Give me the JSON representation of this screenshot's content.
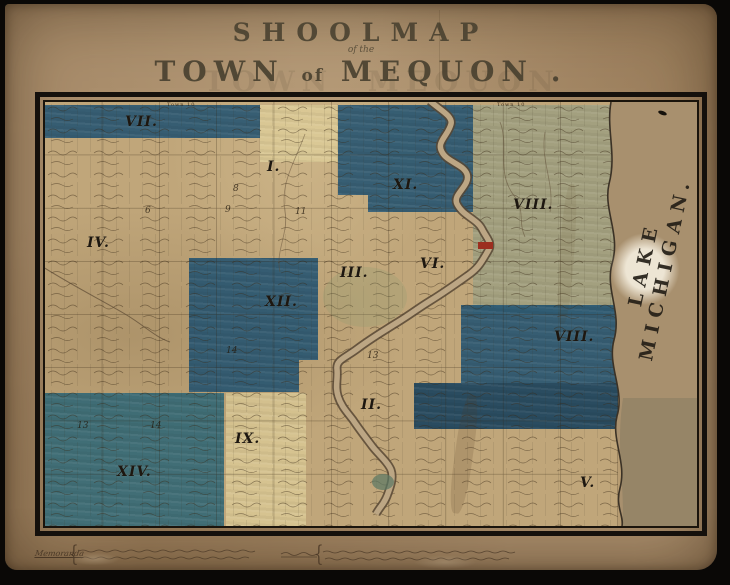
{
  "title": {
    "main": "SHOOLMAP",
    "subscript": "of the",
    "town_word1": "TOWN",
    "town_word2": "of",
    "town_word3": "MEQUON",
    "town_period": "."
  },
  "map": {
    "lake_label": "LAKE MICHIGAN.",
    "top_annotations": [
      "Town 10",
      "Town 10"
    ],
    "districts": [
      {
        "numeral": "VII."
      },
      {
        "numeral": "I."
      },
      {
        "numeral": "XI."
      },
      {
        "numeral": "VIII."
      },
      {
        "numeral": "IV."
      },
      {
        "numeral": "III."
      },
      {
        "numeral": "VI."
      },
      {
        "numeral": "XII."
      },
      {
        "numeral": "VIII."
      },
      {
        "numeral": "II."
      },
      {
        "numeral": "IX."
      },
      {
        "numeral": "XIV."
      },
      {
        "numeral": "V."
      }
    ],
    "section_numbers": [
      {
        "value": "8"
      },
      {
        "value": "6"
      },
      {
        "value": "9"
      },
      {
        "value": "11"
      },
      {
        "value": "14"
      },
      {
        "value": "13"
      },
      {
        "value": "14"
      },
      {
        "value": "13"
      }
    ],
    "colors": {
      "paper": "#a98d6b",
      "land": "#c0a67a",
      "district_blue": "#1d4d70",
      "district_teal": "#2a6076",
      "district_green": "#8a9a84",
      "pale_yellow": "#d8cc96",
      "river_outline": "#574634",
      "village_red": "#9c2e1f",
      "frame_black": "#14100c",
      "lake_paper": "#a8906e"
    }
  },
  "legend": {
    "left_label": "Memoranda",
    "brace": "{"
  }
}
